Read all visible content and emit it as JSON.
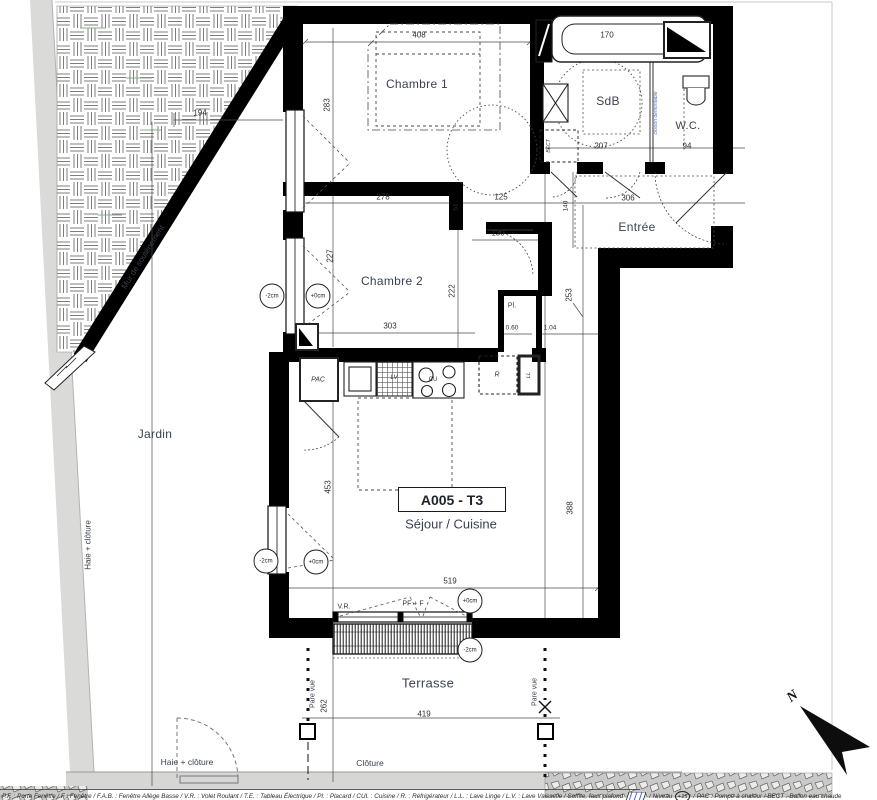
{
  "unit": {
    "code": "A005 - T3",
    "type": "Séjour / Cuisine"
  },
  "rooms": {
    "chambre1": "Chambre 1",
    "chambre2": "Chambre 2",
    "sdb": "SdB",
    "wc": "W.C.",
    "entree": "Entrée",
    "jardin": "Jardin",
    "terrasse": "Terrasse"
  },
  "site": {
    "mur_soutenement": "Mur de soutènement",
    "haie_cloture_side": "Haie + clôture",
    "haie_cloture_bottom": "Haie + clôture",
    "cloture": "Clôture",
    "pare_vue_left": "Pare vue",
    "pare_vue_right": "Pare vue"
  },
  "fixtures": {
    "pac": "PAC",
    "fridge": "R",
    "washer": "LL",
    "dishwasher": "LV",
    "hob": "CU",
    "closet": "Pl.",
    "water_heater": "BECT",
    "partition": "cloison démontable",
    "shutter": "V.R.",
    "window_type": "PF + F",
    "north": "N"
  },
  "dims": {
    "d408": "408",
    "d283": "283",
    "d194": "194",
    "d278": "278",
    "d125": "125",
    "d61": "61",
    "d170": "170",
    "d207": "207",
    "d94": "94",
    "d306": "306",
    "d140": "140",
    "d130": "130",
    "d227": "227",
    "d222": "222",
    "d303": "303",
    "d253": "253",
    "d060": "0.60",
    "d104": "1.04",
    "d453": "453",
    "d388": "388",
    "d519": "519",
    "d419": "419",
    "d262": "262"
  },
  "levels": {
    "l1": "-2cm",
    "l2": "+0cm",
    "l3": "-2cm",
    "l4": "+0cm",
    "l5": "+0cm",
    "l6": "-2cm"
  },
  "legend": {
    "part1": "P.F. : Porte Fenêtre / F : Fenêtre / F.A.B. : Fenêtre Allège Basse / V.R. : Volet Roulant / T.E. : Tableau Électrique / Pl. : Placard / CUI. : Cuisine / R. : Réfrigérateur / L.L. : Lave Linge / L.V. : Lave Vaisselle / Soffite, faux plafond",
    "niveau": "/ Niveau",
    "niveau_value": "+15",
    "part2": "/ PAC : Pompe à chaleur / BECT : Ballon eau chaude"
  },
  "colors": {
    "wall": "#000000",
    "label_text": "#39424e",
    "site_gray": "#d8d8d6",
    "legend_hatch_blue": "#3b5bd0"
  }
}
